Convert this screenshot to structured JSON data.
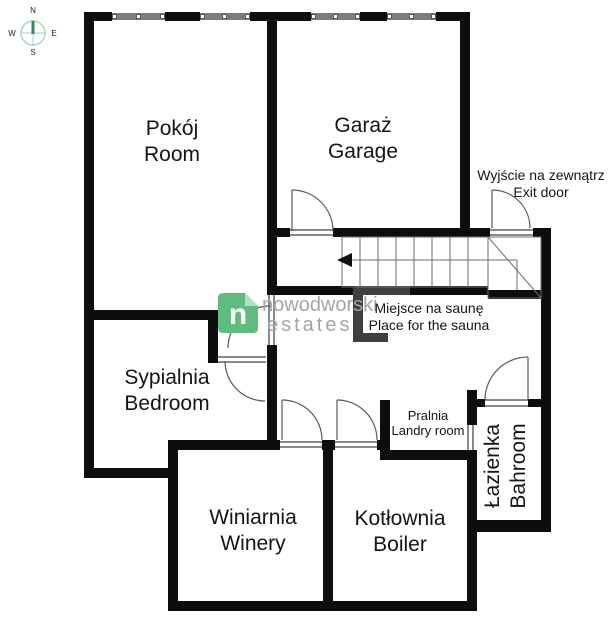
{
  "title": "Floor plan",
  "compass": {
    "n": "N",
    "w": "W",
    "e": "E",
    "s": "S"
  },
  "watermark": {
    "logo_letter": "n",
    "brand_top": "nowodworski",
    "brand_bottom": "estates"
  },
  "rooms": [
    {
      "id": "pokoj",
      "name_pl": "Pokój",
      "name_en": "Room"
    },
    {
      "id": "garaz",
      "name_pl": "Garaż",
      "name_en": "Garage"
    },
    {
      "id": "sypialnia",
      "name_pl": "Sypialnia",
      "name_en": "Bedroom"
    },
    {
      "id": "winiarnia",
      "name_pl": "Winiarnia",
      "name_en": "Winery"
    },
    {
      "id": "kotlownia",
      "name_pl": "Kotłownia",
      "name_en": "Boiler"
    },
    {
      "id": "lazienka",
      "name_pl": "Łazienka",
      "name_en": "Bahroom"
    },
    {
      "id": "pralnia",
      "name_pl": "Pralnia",
      "name_en": "Landry room"
    }
  ],
  "annotations": {
    "exit": {
      "pl": "Wyjście na zewnątrz",
      "en": "Exit door"
    },
    "sauna": {
      "pl": "Miejsce na saunę",
      "en": "Place for the sauna"
    }
  },
  "colors": {
    "wall": "#0d0d0d",
    "sauna_wall": "#3f3f3f",
    "window": "#7d7d7d",
    "threshold": "#8a8a8a",
    "line": "#5a5a5a",
    "logo_green": "#5ebd7e",
    "logo_fold": "#b0dfc2",
    "watermark_gray": "#a5a5a5",
    "compass_ring": "#9fd4b8",
    "compass_needle": "#2f8c5a"
  }
}
